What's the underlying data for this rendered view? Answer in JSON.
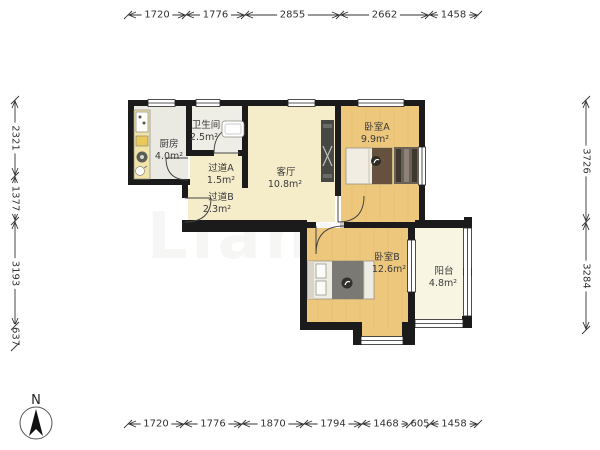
{
  "plan_title": "2室1厅户型图",
  "watermark": {
    "big": "Lianjia",
    "small": ".com"
  },
  "compass": {
    "label": "N"
  },
  "rooms": [
    {
      "id": "kitchen",
      "name": "厨房",
      "area": "4.0m²"
    },
    {
      "id": "bathroom",
      "name": "卫生间",
      "area": "2.5m²"
    },
    {
      "id": "hallway-a",
      "name": "过道A",
      "area": "1.5m²"
    },
    {
      "id": "hallway-b",
      "name": "过道B",
      "area": "2.3m²"
    },
    {
      "id": "living",
      "name": "客厅",
      "area": "10.8m²"
    },
    {
      "id": "bedroom-a",
      "name": "卧室A",
      "area": "9.9m²"
    },
    {
      "id": "bedroom-b",
      "name": "卧室B",
      "area": "12.6m²"
    },
    {
      "id": "balcony",
      "name": "阳台",
      "area": "4.8m²"
    }
  ],
  "dimensions": {
    "top": [
      "1720",
      "1776",
      "2855",
      "2662",
      "1458"
    ],
    "bottom": [
      "1720",
      "1776",
      "1870",
      "1794",
      "1468",
      "605",
      "1458"
    ],
    "left": [
      "2321",
      "1377",
      "3193",
      "637"
    ],
    "right": [
      "3726",
      "3284"
    ]
  }
}
